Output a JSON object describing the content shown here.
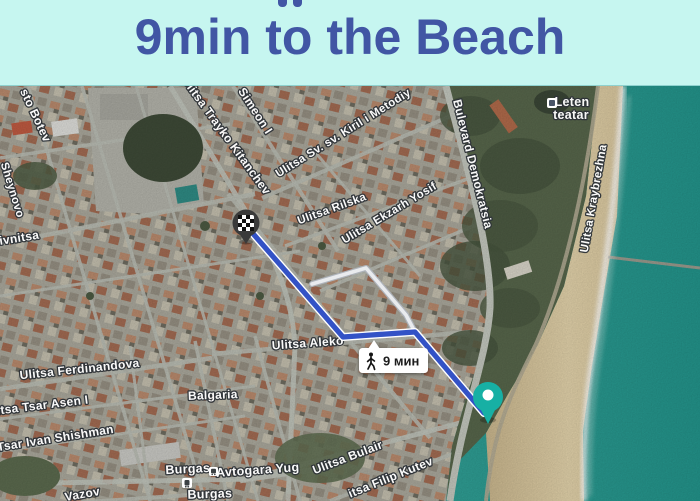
{
  "header": {
    "title": "9min to the Beach",
    "background_color": "#c6f6f0",
    "text_color": "#4156a4",
    "note": "top line of text cropped; only letter descenders visible"
  },
  "map": {
    "kind": "satellite-map-with-walking-route",
    "route": {
      "mode": "walking",
      "duration_label": "9 мин",
      "color": "#3352c6",
      "points_px": [
        [
          249,
          143
        ],
        [
          343,
          251
        ],
        [
          415,
          246
        ],
        [
          484,
          327
        ]
      ],
      "alt_points_px": [
        [
          312,
          198
        ],
        [
          366,
          182
        ],
        [
          406,
          229
        ],
        [
          415,
          246
        ]
      ]
    },
    "markers": [
      {
        "id": "destination-flag",
        "style": "checkered-flag-pin",
        "x": 246,
        "y": 137
      },
      {
        "id": "origin-pin",
        "style": "teal-circle-pin",
        "color": "#17b0a4",
        "x": 488,
        "y": 311
      }
    ],
    "labels": [
      {
        "text": "sto Botev",
        "x": 32,
        "y": 31,
        "rot": 65,
        "size": 12
      },
      {
        "text": "Sheynovo",
        "x": 9,
        "y": 105,
        "rot": 73,
        "size": 11.5
      },
      {
        "text": "livnitsa",
        "x": 18,
        "y": 156,
        "rot": -9,
        "size": 12
      },
      {
        "text": "Ulitsa Trayko Kitanchev",
        "x": 223,
        "y": 52,
        "rot": 54,
        "size": 12
      },
      {
        "text": "Simeon I",
        "x": 252,
        "y": 27,
        "rot": 57,
        "size": 12
      },
      {
        "text": "Ulitsa Sv. sv. Kiril i Metodiy",
        "x": 345,
        "y": 50,
        "rot": -32,
        "size": 11.5
      },
      {
        "text": "Ulitsa Rilska",
        "x": 333,
        "y": 126,
        "rot": -20,
        "size": 11.5
      },
      {
        "text": "Ulitsa Ekzarh Yosif",
        "x": 391,
        "y": 130,
        "rot": -31,
        "size": 11.5
      },
      {
        "text": "Bulevard Demokratsia",
        "x": 469,
        "y": 79,
        "rot": 76,
        "size": 12
      },
      {
        "text": "Ulitsa Kraybrezhna",
        "x": 597,
        "y": 113,
        "rot": -80,
        "size": 11.5
      },
      {
        "text": "Ulitsa Aleko",
        "x": 308,
        "y": 261,
        "rot": -4,
        "size": 12
      },
      {
        "text": "Ulitsa Ferdinandova",
        "x": 80,
        "y": 287,
        "rot": -6,
        "size": 12
      },
      {
        "text": "itsa Tsar Asen I",
        "x": 43,
        "y": 323,
        "rot": -7,
        "size": 12
      },
      {
        "text": "Tsar Ivan Shishman",
        "x": 56,
        "y": 356,
        "rot": -9,
        "size": 12
      },
      {
        "text": "Vazov",
        "x": 83,
        "y": 412,
        "rot": -10,
        "size": 12
      },
      {
        "text": "Ulitsa Bulair",
        "x": 349,
        "y": 375,
        "rot": -21,
        "size": 12
      },
      {
        "text": "itsa Filip Kutev",
        "x": 392,
        "y": 395,
        "rot": -22,
        "size": 12
      },
      {
        "text": "Balgaria",
        "x": 213,
        "y": 313,
        "rot": -2,
        "size": 12
      },
      {
        "text": "Burgas",
        "x": 188,
        "y": 387,
        "rot": -3,
        "size": 12.5
      },
      {
        "text": "Avtogara Yug",
        "x": 258,
        "y": 388,
        "rot": -4,
        "size": 12.5
      },
      {
        "text": "Burgas",
        "x": 210,
        "y": 412,
        "rot": -2,
        "size": 12.5
      },
      {
        "text": "Leten",
        "x": 572,
        "y": 20,
        "rot": 0,
        "size": 12.5
      },
      {
        "text": "teatar",
        "x": 571,
        "y": 33,
        "rot": 0,
        "size": 12.5
      }
    ],
    "colors": {
      "sea": "#2a9a90",
      "sand": "#dcc9a0",
      "park": "#57664b",
      "city_base": "#aaa89c",
      "road": "#bcc0b7"
    }
  }
}
